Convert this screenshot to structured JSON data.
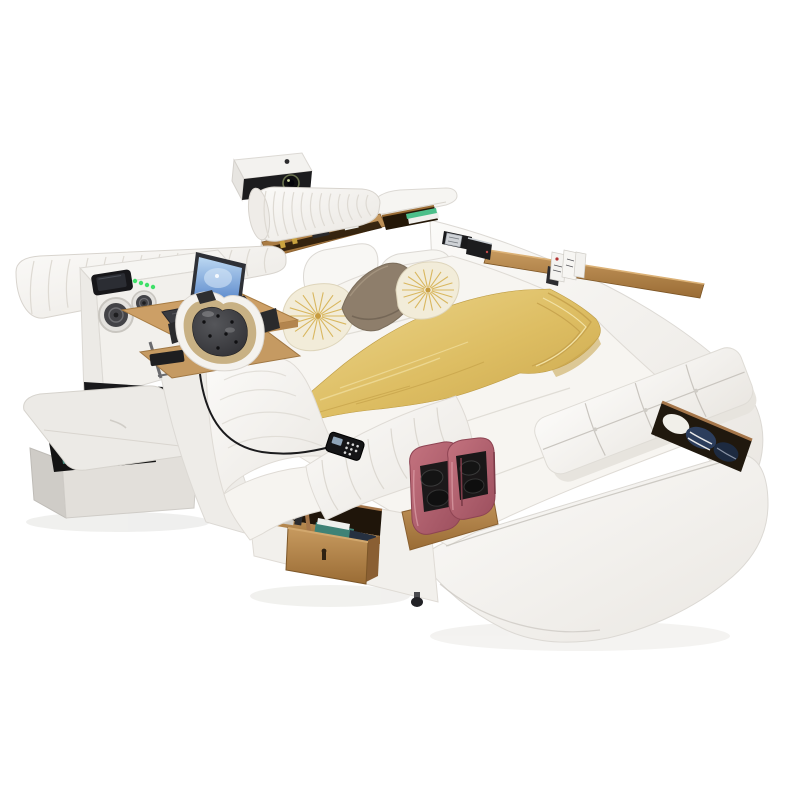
{
  "image": {
    "alt": "Multifunctional smart leather bed with projector, rolled headboard, speakers, laptop tray, massage chaise with dark tufted headrest, gold runner blanket, decorative pillows, tufted side bench, foot massager, open storage drawer and storage ottoman",
    "background": "#ffffff"
  },
  "palette": {
    "leather_white": "#f6f4f1",
    "leather_shadow": "#e7e4df",
    "seam_grey": "#d9d5cf",
    "wood_light": "#c79a5f",
    "wood_dark": "#9a6c35",
    "wood_slot": "#241707",
    "gold_light": "#eed992",
    "gold_mid": "#ddbd62",
    "gold_deep": "#c7a34a",
    "pink_light": "#c4737f",
    "pink_dark": "#9c4f5e",
    "pink_maroon": "#7c3b48",
    "cushion_grey": "#55565a",
    "cushion_black": "#2b2b2f",
    "pillow_cream": "#f2ecd9",
    "pillow_ray_gold": "#d9b75f",
    "pillow_taupe": "#8e7e6b",
    "screen_top": "#bcd8f2",
    "screen_bottom": "#4f7fc7",
    "led_green": "#3fe068",
    "book_green": "#4cbf8a",
    "book_teal": "#3e8276",
    "cloth_navy": "#2c3d5c",
    "device_black": "#1c1c1e",
    "roller_black": "#141414",
    "recess_black": "#19191b"
  },
  "objects": {
    "projector": "projector on stand",
    "headboard": "pleated roll headboard",
    "speakers": "built-in speakers",
    "wireless_charger": "phone charging pad with green LEDs",
    "laptop": "laptop on fold-out wood tray",
    "massage_headrest": "dark tufted massage headrest",
    "chaise": "white leather massage chaise",
    "remote": "massage remote control",
    "gold_blanket": "gold runner blanket",
    "bench": "tufted side bench",
    "foot_massager": "pink foot massager",
    "drawer": "open wood storage drawer",
    "ottoman": "storage ottoman",
    "bookshelf": "open shelf with books"
  }
}
